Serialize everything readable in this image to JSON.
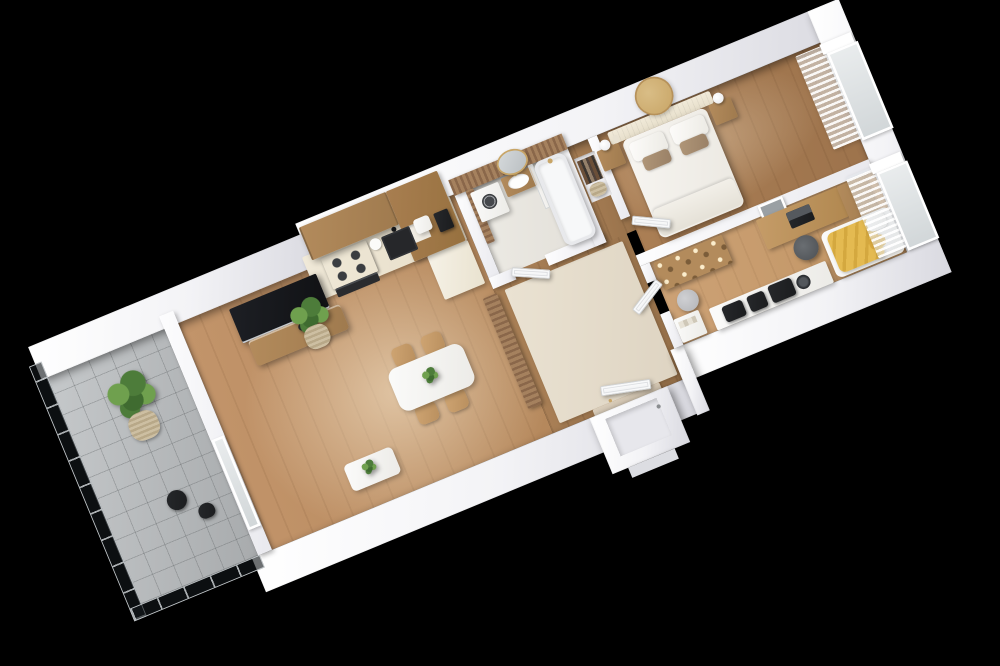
{
  "scene": {
    "kind": "3d-isometric-floor-plan-render",
    "background": "#000000",
    "apartment_shape": "long rectangular one-bedroom apartment with balcony, shown cut-away from above at a diagonal angle",
    "text_on_image": "none"
  },
  "palette": {
    "wall": "#f3f3f6",
    "woodFloor": "#c2946a",
    "woodFloorDark": "#ab7f55",
    "woodFloorLight": "#cda276",
    "woodCab": "#b38b5c",
    "woodTall": "#a87e50",
    "cream": "#f0e9d8",
    "rug": "#eae2d2",
    "bathFloor": "#edebe5",
    "bathWood": "#a5815e",
    "gold": "#c8a566",
    "mustard": "#e4ba51",
    "green": "#4d7c3a",
    "greenLight": "#6fa04e",
    "dark": "#1b1c1e",
    "taupe": "#b09678",
    "bedWhite": "#f7f5f1",
    "glassRail": "rgba(20,25,28,0.62)",
    "tileGrey": "#b7babc"
  },
  "rooms": [
    {
      "name": "balcony",
      "floor": "grey ceramic tiles",
      "items": [
        "glass balustrade with dark panels",
        "large potted plant in woven basket",
        "small dark bistro table",
        "dark chair"
      ]
    },
    {
      "name": "living-room",
      "floor": "light oak planks with sun patch",
      "items": [
        "wall-mounted black TV",
        "wood media console with vases",
        "potted plant in wicker basket",
        "white coffee table with small plant",
        "white dining table with plant",
        "four wooden dining chairs",
        "glass balcony door"
      ]
    },
    {
      "name": "kitchen",
      "floor": "light oak planks",
      "items": [
        "cream L-shaped counter",
        "two wood upper cabinets",
        "tall wood cabinet with open shelf",
        "black induction cooktop",
        "black built-in oven",
        "black sink with black faucet",
        "white kettle",
        "white multicooker",
        "dark coffee machine"
      ]
    },
    {
      "name": "entry-hall",
      "floor": "dark oak with beige rug",
      "items": [
        "wood slat partition screen",
        "white entrance door with gold handle",
        "recessed entrance porch",
        "keyhole plate on outer wall"
      ]
    },
    {
      "name": "bathroom",
      "floor": "pale stone tiles",
      "items": [
        "wood slat accent wall",
        "oval mirror with gold frame",
        "floating wood vanity with white basin and gold faucet",
        "white washing machine with dark round door",
        "white bathtub with gold shower set",
        "glass shower screen",
        "white panel door"
      ]
    },
    {
      "name": "bedroom",
      "floor": "oak planks",
      "items": [
        "double bed with white duvet",
        "two white pillows",
        "two taupe pillows",
        "cream fluted headboard",
        "round gold wall mirror",
        "two wood nightstands",
        "two white sphere lamps",
        "vase with dried flowers",
        "built-in niche with books and basket",
        "window with sheer curtains",
        "white panel door"
      ]
    },
    {
      "name": "home-office",
      "floor": "light oak planks",
      "items": [
        "wood desk",
        "dark laptop",
        "wood drawer unit",
        "framed picture on wall",
        "dark desk chair",
        "wardrobe with wood mosaic front",
        "grey round pouf",
        "white open shelf unit",
        "daybed with mustard yellow throw",
        "white and gold cushions",
        "storage shelf with dark bags and round fan",
        "window with sheer curtains"
      ]
    }
  ],
  "counts": {
    "windows": 2,
    "interior_doors": 3,
    "entrance_doors": 1,
    "plants": 5
  }
}
